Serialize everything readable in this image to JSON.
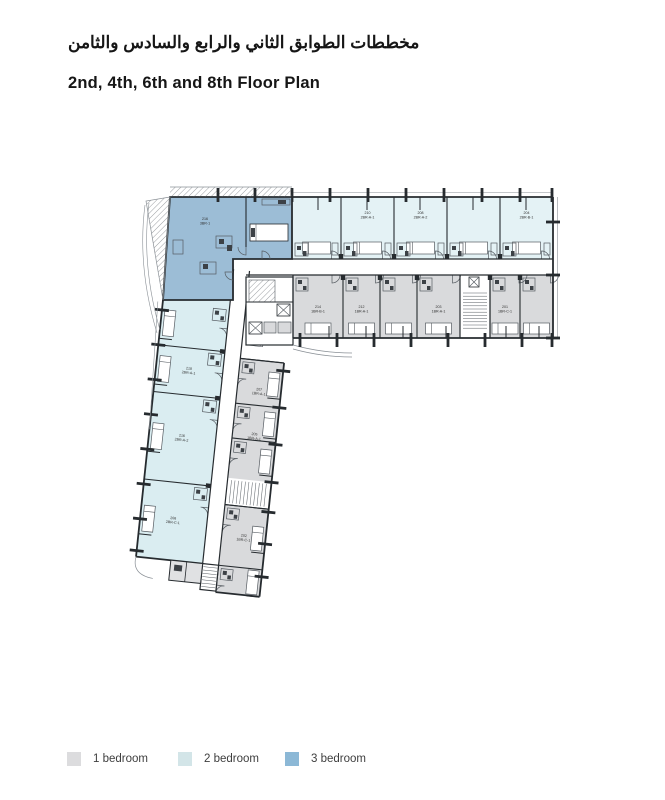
{
  "header": {
    "title_ar": "مخططات الطوابق الثاني والرابع والسادس والثامن",
    "title_en": "2nd, 4th, 6th and 8th Floor Plan"
  },
  "legend": {
    "items": [
      {
        "label": "1 bedroom",
        "color": "#dcdcde"
      },
      {
        "label": "2 bedroom",
        "color": "#d3e5e8"
      },
      {
        "label": "3 bedroom",
        "color": "#8cb8d6"
      }
    ]
  },
  "plan": {
    "colors": {
      "wall": "#262b2f",
      "line": "#565c62",
      "dark": "#3c4146",
      "thin": "#8a9096",
      "cyanA": "#e4f2f5",
      "cyanB": "#daedf1",
      "gray": "#d9dadc",
      "grayRoom": "#e0e1e3",
      "blue": "#9cbdd6",
      "label": "#2e2e2e"
    },
    "wingA": {
      "cyan": {
        "y0": 197,
        "y1": 259,
        "units": [
          {
            "x0": 292,
            "x1": 341,
            "label": null
          },
          {
            "x0": 341,
            "x1": 394,
            "label": [
              "210",
              "2BR-A-1"
            ]
          },
          {
            "x0": 394,
            "x1": 447,
            "label": [
              "208",
              "2BR-A-2"
            ]
          },
          {
            "x0": 447,
            "x1": 500,
            "label": null
          },
          {
            "x0": 500,
            "x1": 553,
            "label": [
              "204",
              "2BR-B-1"
            ]
          }
        ]
      },
      "gray": {
        "y0": 275,
        "y1": 338,
        "core": {
          "x0": 460,
          "x1": 490
        },
        "units": [
          {
            "x0": 293,
            "x1": 343,
            "label": [
              "214",
              "1BR-B-1"
            ]
          },
          {
            "x0": 343,
            "x1": 380,
            "label": [
              "212",
              "1BR-A-1"
            ]
          },
          {
            "x0": 380,
            "x1": 417,
            "label": null
          },
          {
            "x0": 417,
            "x1": 460,
            "label": [
              "203",
              "1BR-A-1"
            ]
          },
          {
            "x0": 490,
            "x1": 520,
            "label": [
              "201",
              "1BR-C-1"
            ]
          },
          {
            "x0": 520,
            "x1": 553,
            "label": null
          }
        ]
      },
      "ticksTop": [
        292,
        330,
        368,
        406,
        444,
        482,
        520,
        552
      ],
      "ticksBottom": [
        300,
        337,
        374,
        411,
        448,
        485,
        522,
        552
      ],
      "ticksRight": [
        222,
        275,
        338
      ]
    },
    "wingB": {
      "angle": 6,
      "pivot": [
        163,
        300
      ],
      "cyan": {
        "x0": 163,
        "x1": 230,
        "units": [
          {
            "y0": 300,
            "y1": 345,
            "label": null
          },
          {
            "y0": 345,
            "y1": 392,
            "label": [
              "218",
              "2BR-A-1"
            ]
          },
          {
            "y0": 392,
            "y1": 480,
            "label": [
              "216",
              "2BR-A-2"
            ]
          },
          {
            "y0": 480,
            "y1": 558,
            "label": [
              "206",
              "2BR-C-1"
            ]
          }
        ]
      },
      "gray": {
        "x0": 246,
        "x1": 290,
        "stair": {
          "y0": 470,
          "y1": 497
        },
        "units": [
          {
            "y0": 350,
            "y1": 395,
            "label": [
              "207",
              "1BR-A-1"
            ]
          },
          {
            "y0": 395,
            "y1": 430,
            "label": [
              "205",
              "1BR-A-1"
            ]
          },
          {
            "y0": 430,
            "y1": 470,
            "label": null
          },
          {
            "y0": 497,
            "y1": 558,
            "label": [
              "202",
              "1BR-C-1"
            ]
          },
          {
            "y0": 558,
            "y1": 585,
            "label": null
          }
        ]
      },
      "corridor": {
        "x0": 230,
        "x1": 246,
        "y0": 262,
        "y1": 585
      },
      "ticksLeft": [
        310,
        345,
        380,
        415,
        450,
        485,
        520,
        552
      ],
      "ticksRight": [
        358,
        395,
        432,
        470,
        500,
        532,
        565
      ]
    },
    "unit3br": {
      "label": [
        "216",
        "3BR-1"
      ]
    }
  }
}
